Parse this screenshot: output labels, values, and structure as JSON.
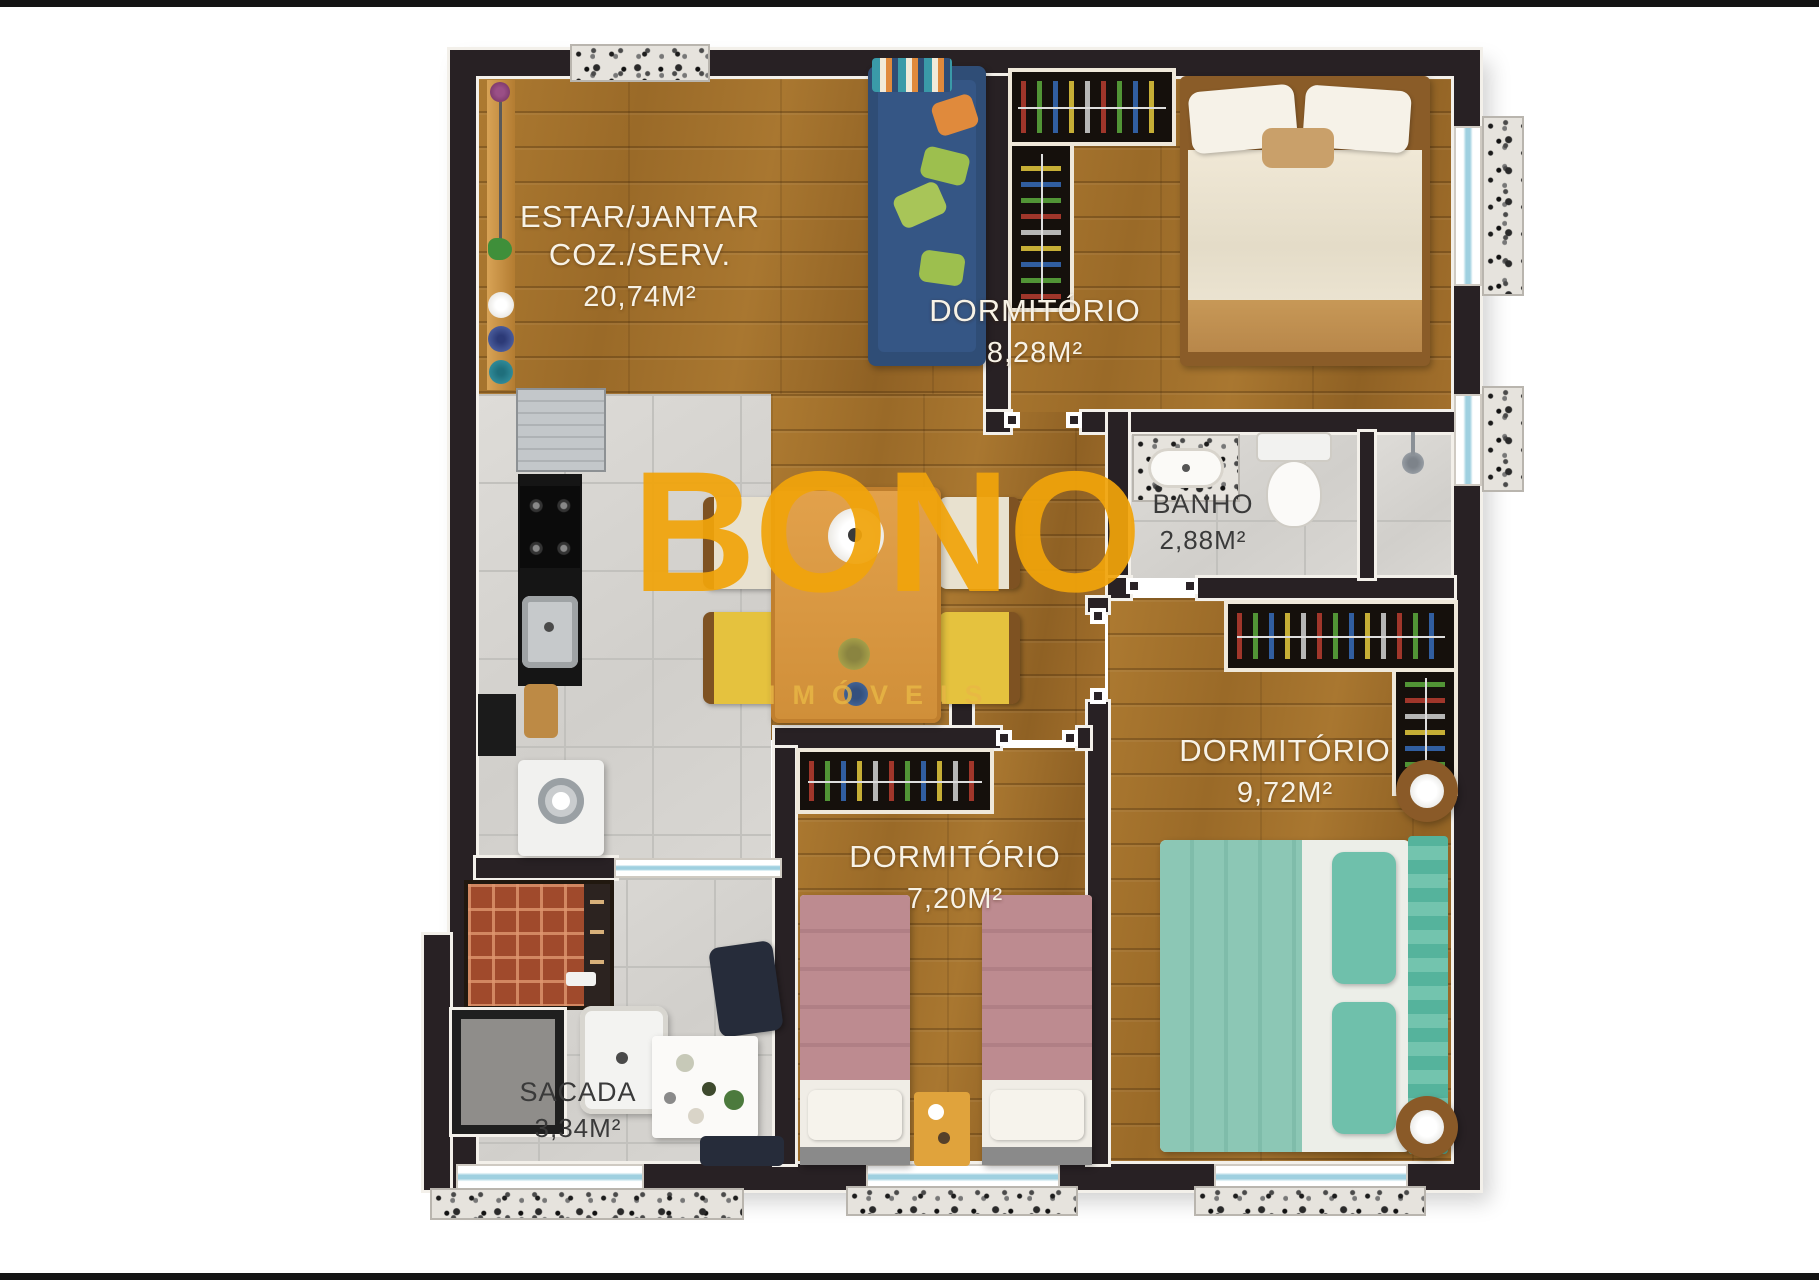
{
  "watermark": {
    "brand": "BONO",
    "sub": "IMÓVEIS",
    "brand_color": "#f1a40b",
    "sub_color": "#e9b845"
  },
  "rooms": {
    "living": {
      "line1": "ESTAR/JANTAR",
      "line2": "COZ./SERV.",
      "area": "20,74M²"
    },
    "bedroom1": {
      "name": "DORMITÓRIO",
      "area": "8,28M²"
    },
    "bathroom": {
      "name": "BANHO",
      "area": "2,88M²"
    },
    "bedroom2": {
      "name": "DORMITÓRIO",
      "area": "9,72M²"
    },
    "bedroom3": {
      "name": "DORMITÓRIO",
      "area": "7,20M²"
    },
    "balcony": {
      "name": "SACADA",
      "area": "3,34M²"
    }
  },
  "palette": {
    "wood": "#a5742e",
    "tile": "#d8d7d3",
    "wall": "#282124",
    "granite": "#e6e3dd",
    "label_light": "#f7f2e6",
    "label_dark": "#3a3a3a",
    "sofa_blue": "#2f4d76",
    "bed_teal": "#8cc7b5",
    "bed_mauve": "#bd8b90",
    "table_orange": "#dc9a43",
    "bbq_brick": "#a04a2c"
  }
}
